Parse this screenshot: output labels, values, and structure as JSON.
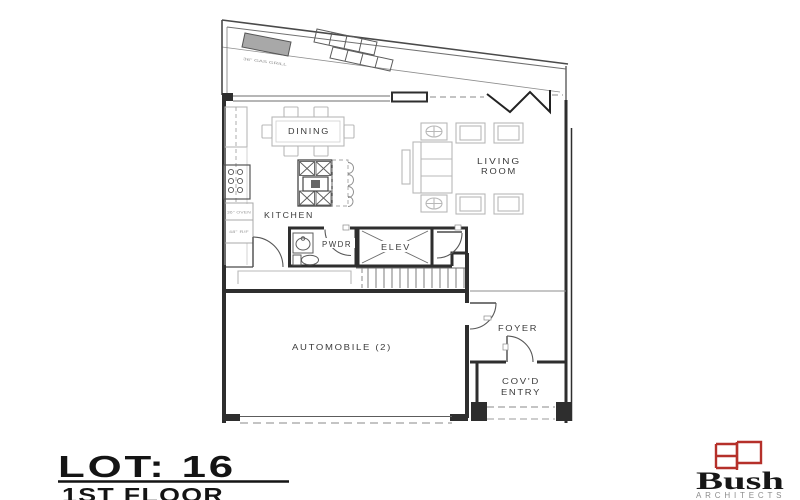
{
  "title_block": {
    "lot": "LOT: 16",
    "floor": "1ST FLOOR"
  },
  "rooms": {
    "dining": "DINING",
    "living_line1": "LIVING",
    "living_line2": "ROOM",
    "kitchen": "KITCHEN",
    "pwdr": "PWDR",
    "elev": "ELEV",
    "foyer": "FOYER",
    "automobile": "AUTOMOBILE (2)",
    "covd_line1": "COV'D",
    "covd_line2": "ENTRY"
  },
  "appliances": {
    "oven": "36\" OVEN",
    "fridge": "48\" R/F",
    "grill": "36\" GAS GRILL"
  },
  "logo": {
    "name": "Bush",
    "subtitle": "ARCHITECTS",
    "monogram": "BA",
    "brand_red": "#b5302a"
  },
  "colors": {
    "wall": "#2e2e2e",
    "furniture": "#b8b8b8",
    "grill_fill": "#a8a8a8",
    "background": "#ffffff"
  }
}
